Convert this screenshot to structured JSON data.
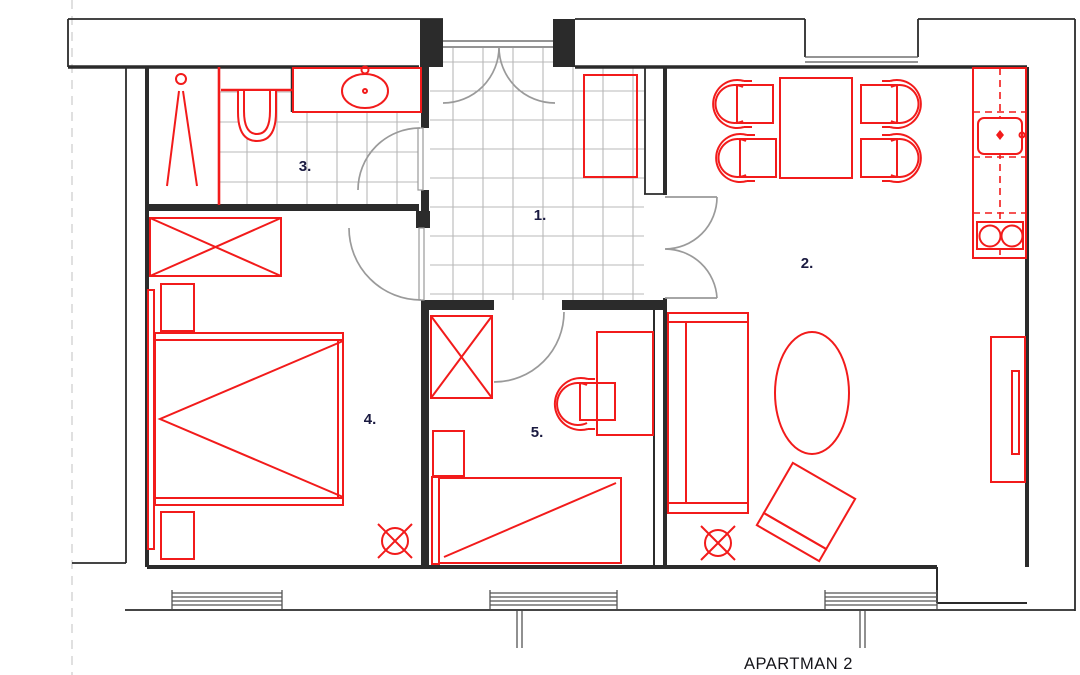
{
  "plan": {
    "title": "APARTMAN 2"
  },
  "rooms": [
    {
      "id": "hall",
      "label": "1."
    },
    {
      "id": "living-room",
      "label": "2."
    },
    {
      "id": "bathroom",
      "label": "3."
    },
    {
      "id": "bedroom",
      "label": "4."
    },
    {
      "id": "small-room",
      "label": "5."
    }
  ],
  "colors": {
    "furniture": "#f21b1b",
    "walls": "#2b2b2b",
    "doors": "#9a9a9a",
    "tiles": "#b8b8b8",
    "label_text": "#1a1a40",
    "title_text": "#15151a",
    "background": "#ffffff"
  }
}
